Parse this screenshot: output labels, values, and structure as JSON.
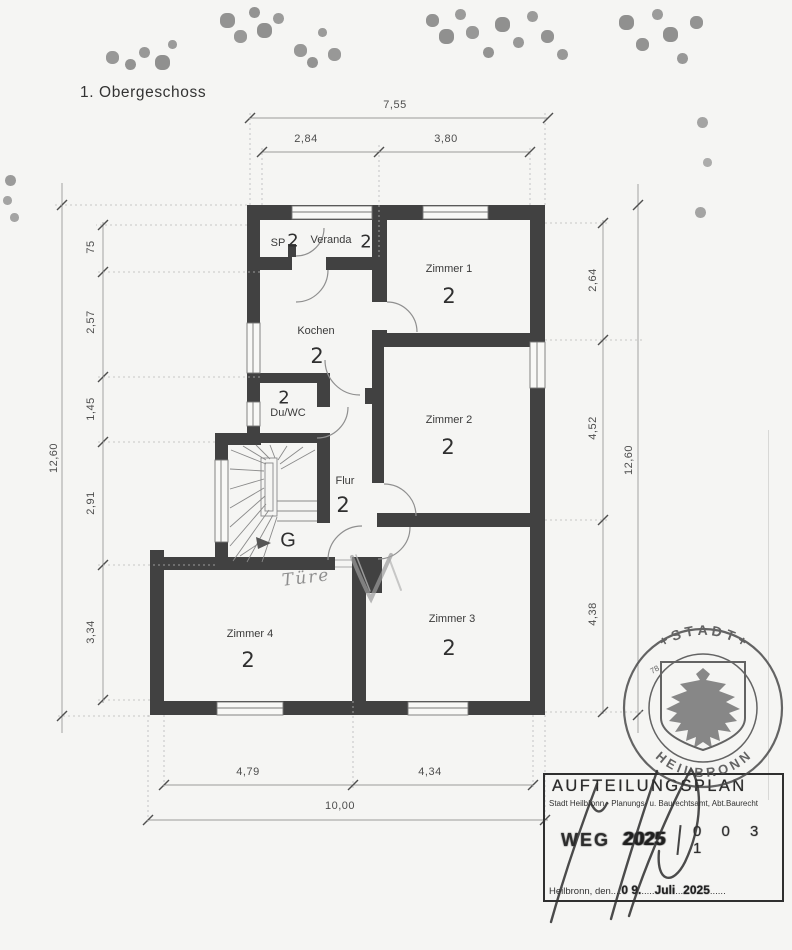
{
  "title": "1. Obergeschoss",
  "rooms": {
    "sp": {
      "label": "SP",
      "unit": "2"
    },
    "veranda": {
      "label": "Veranda",
      "unit": "2"
    },
    "zimmer1": {
      "label": "Zimmer 1",
      "unit": "2"
    },
    "zimmer2": {
      "label": "Zimmer 2",
      "unit": "2"
    },
    "zimmer3": {
      "label": "Zimmer 3",
      "unit": "2"
    },
    "zimmer4": {
      "label": "Zimmer 4",
      "unit": "2"
    },
    "kochen": {
      "label": "Kochen",
      "unit": "2"
    },
    "duwc": {
      "label": "Du/WC",
      "unit": "2"
    },
    "flur": {
      "label": "Flur",
      "unit": "2"
    },
    "treppe": {
      "label": "G"
    }
  },
  "annotations": {
    "tuere": "Türe"
  },
  "dimensions": {
    "top_total": "7,55",
    "top_seg1": "2,84",
    "top_seg2": "3,80",
    "left_total": "12,60",
    "left_seg1": "75",
    "left_seg2": "2,57",
    "left_seg3": "1,45",
    "left_seg4": "2,91",
    "left_seg5": "3,34",
    "right_seg1": "2,64",
    "right_seg2": "4,52",
    "right_seg3": "4,38",
    "right_total": "12,60",
    "bottom_seg1": "4,79",
    "bottom_seg2": "4,34",
    "bottom_total": "10,00"
  },
  "stamp": {
    "title": "AUFTEILUNGSPLAN",
    "subtitle": "Stadt Heilbronn - Planungs- u. Baurechtsamt, Abt.Baurecht",
    "weg_label": "WEG",
    "weg_year": "2025",
    "weg_number": "0 0 3 1",
    "city_prefix": "Heilbronn, den",
    "dots_a": "....",
    "date_day": "0 9.",
    "dots_b": ".....",
    "date_month": "Juli",
    "dots_c": "...",
    "date_year": "2025",
    "dots_d": "......"
  },
  "seal": {
    "arc_top": "+ S T A D T +",
    "arc_bottom": "H E I L B R O N N",
    "number": "78"
  },
  "colors": {
    "wall": "#414141",
    "paper": "#f5f5f3",
    "stamp_ink": "#4a4a4a"
  }
}
